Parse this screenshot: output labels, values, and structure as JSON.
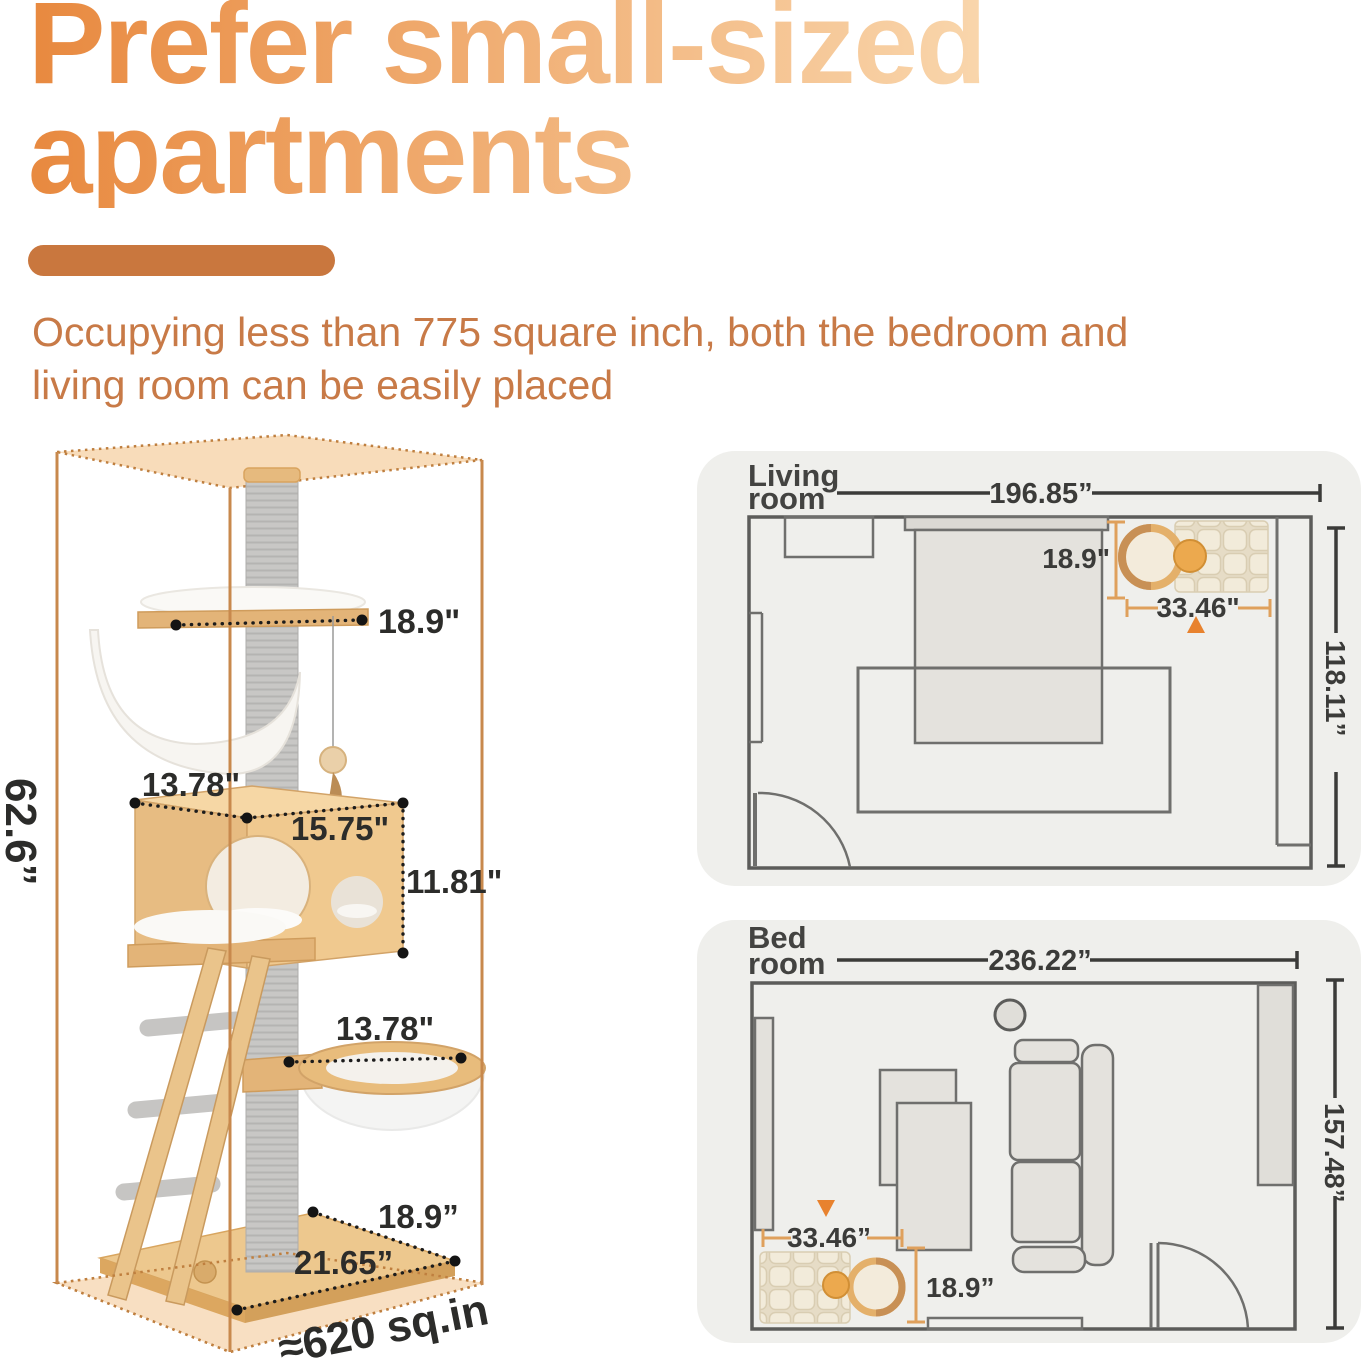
{
  "header": {
    "title_line1": "Prefer small-sized",
    "title_line2": "apartments",
    "subtitle_line1": "Occupying less than 775 square inch, both the bedroom and",
    "subtitle_line2": "living room can be easily placed"
  },
  "cat_tree": {
    "overall_height": "62.6”",
    "top_platform_width": "18.9\"",
    "condo_depth": "13.78\"",
    "condo_width": "15.75\"",
    "condo_height": "11.81\"",
    "capsule_width": "13.78\"",
    "base_depth": "18.9”",
    "base_width": "21.65”",
    "footprint": "≈620 sq.in"
  },
  "living_room": {
    "title_line1": "Living",
    "title_line2": "room",
    "room_width": "196.85”",
    "room_depth": "118.11”",
    "tree_depth": "18.9\"",
    "tree_width": "33.46\""
  },
  "bedroom": {
    "title_line1": "Bed",
    "title_line2": "room",
    "room_width": "236.22”",
    "room_depth": "157.48”",
    "tree_width": "33.46”",
    "tree_depth": "18.9”"
  },
  "colors": {
    "title_gradient_start": "#e8893f",
    "title_gradient_end": "#f9d6ac",
    "accent_bar": "#c9773e",
    "subtitle_text": "#c87a47",
    "dimension_text": "#2c2c2a",
    "box_outline": "#c8894d",
    "box_face_fill": "#f8dcba",
    "panel_background": "#efefec",
    "plan_wall": "#5c5c5a",
    "plan_furniture_fill": "#e4e2dd",
    "orange_bracket": "#dfa05c",
    "orange_marker": "#e8822e"
  }
}
